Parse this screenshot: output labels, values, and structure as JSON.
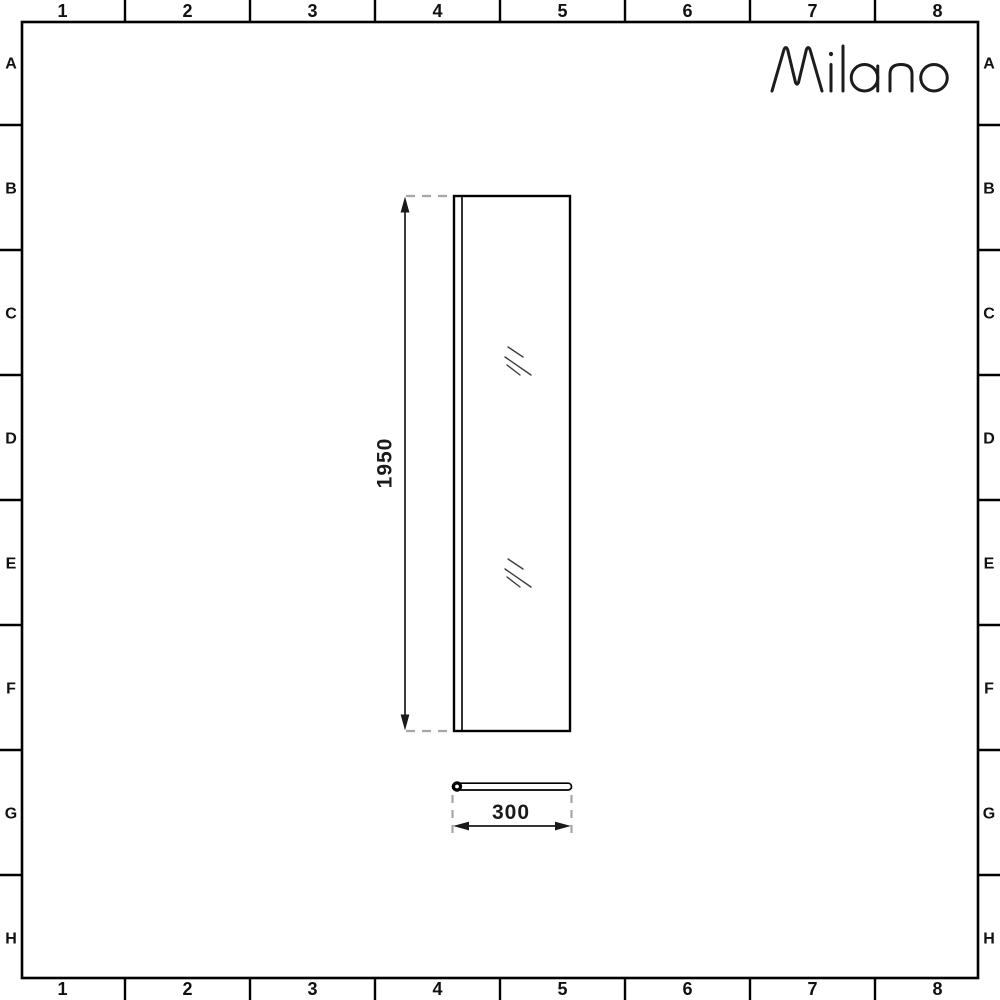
{
  "brand": {
    "name": "Milano"
  },
  "grid": {
    "cols": [
      "1",
      "2",
      "3",
      "4",
      "5",
      "6",
      "7",
      "8"
    ],
    "rows": [
      "A",
      "B",
      "C",
      "D",
      "E",
      "F",
      "G",
      "H"
    ]
  },
  "dimensions": {
    "height": {
      "value": "1950"
    },
    "width": {
      "value": "300"
    }
  },
  "icons": {
    "glass_marks": "glass-reflection",
    "pivot_end": "wall-profile-pivot"
  },
  "colors": {
    "line": "#000000",
    "dash": "#a6a6a6",
    "glass_mark": "#3d3d3d",
    "logo": "#1c1c1c",
    "background": "#ffffff"
  }
}
